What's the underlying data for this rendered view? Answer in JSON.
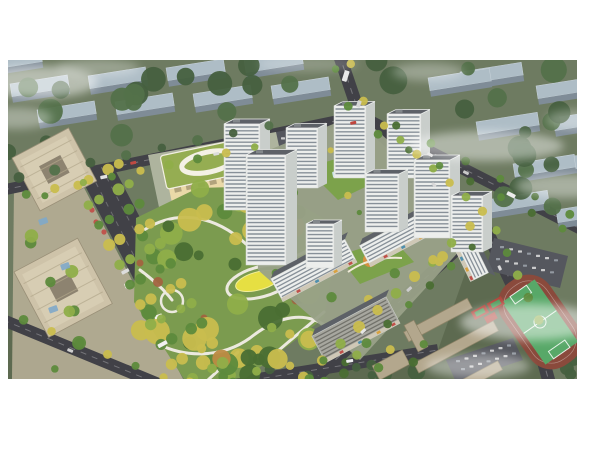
{
  "scene": {
    "type": "aerial-architectural-rendering",
    "description": "Bird's-eye masterplan rendering of a residential development: white high-rise apartment towers around green courtyards, a large landscaped park with winding white paths and a yellow lawn, a kindergarten with a green roof and white oval ring, tree-lined boulevard, tan office towers at left, a school campus with running-track sports field at lower right, muted blue-grey city blocks in the background and drifting white cloud wisps. No text is visible in the image.",
    "elements": [
      {
        "name": "background-city-blocks",
        "label": "Rows of muted blue-grey slab buildings on green ground"
      },
      {
        "name": "perimeter-roads",
        "label": "Dark asphalt roads bounding the site with faint lane markings"
      },
      {
        "name": "tree-lined-boulevard",
        "label": "Wide avenue with dense rows of yellow and green trees"
      },
      {
        "name": "central-park",
        "label": "Large park with tree clusters, winding white paths, yellow oval lawn"
      },
      {
        "name": "kindergarten",
        "label": "Low building with green roof and white oval ring motif"
      },
      {
        "name": "residential-towers",
        "label": "White high-rise towers with horizontal window bands",
        "count": 9
      },
      {
        "name": "retail-slab-buildings",
        "label": "White mid-rise slabs with street-level retail along south road"
      },
      {
        "name": "courtyard-decks",
        "label": "Green amenity decks with pool and orange playground"
      },
      {
        "name": "office-towers-plaza",
        "label": "Two tan office towers with landscaped plaza"
      },
      {
        "name": "south-campus-sports",
        "label": "Tan campus buildings, parking, running track, basketball courts"
      },
      {
        "name": "vehicles",
        "label": "Small buses and cars on the roads"
      },
      {
        "name": "cloud-wisps",
        "label": "Soft white fog patches over corners of the scene"
      }
    ]
  },
  "colors": {
    "canvas_bg": "#ffffff",
    "ground": "#6e7b61",
    "ground_south": "#5b674e",
    "road": "#414147",
    "road_light": "#55575e",
    "lane_mark": "#ffffff",
    "bg_block_top": "#aebdc6",
    "bg_block_side": "#7f8c97",
    "bg_tree": "#46603f",
    "bg_tree2": "#53714a",
    "park_base": "#7b9b4f",
    "paving": "#99a188",
    "school_apron": "#aeb49e",
    "tree_dark": "#4a6e33",
    "tree_green": "#5d8a3c",
    "tree_light": "#8fae49",
    "tree_yellow": "#c9bd4e",
    "tree_orange": "#bd8b43",
    "path": "#ece9df",
    "lawn_yellow": "#e6df42",
    "tower_face": "#eceeec",
    "tower_side": "#c9cecb",
    "tower_band": "#6e7984",
    "tower_roof": "#5d6167",
    "slab_grey": "#a7a79f",
    "school_roof": "#95ad52",
    "school_wall": "#ead9a8",
    "office_tan": "#cec3a9",
    "office_core": "#8d8370",
    "plaza_tan": "#b6ae96",
    "campus_tan": "#b3a78d",
    "field_green": "#58a868",
    "track_red": "#8a4a3c",
    "court_red": "#b0453b",
    "court_green": "#4f9a5a",
    "deck_green": "#7ca24b",
    "play_orange": "#d98f3f",
    "canopy_blue": "#7fa8c9",
    "cloud": "#ffffff"
  }
}
